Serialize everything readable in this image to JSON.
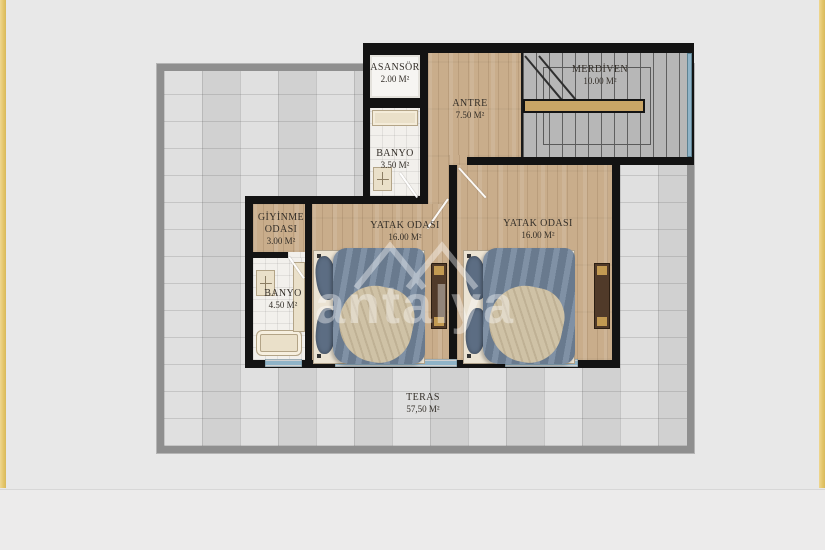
{
  "plan": {
    "watermark": "antalya",
    "rooms": {
      "asansor": {
        "name": "ASANSÖR",
        "area": "2.00 M²"
      },
      "banyo_ust": {
        "name": "BANYO",
        "area": "3.50 M²"
      },
      "antre": {
        "name": "ANTRE",
        "area": "7.50 M²"
      },
      "merdiven": {
        "name": "MERDİVEN",
        "area": "10.00 M²"
      },
      "giyinme": {
        "name": "GİYİNME ODASI",
        "area": "3.00 M²"
      },
      "banyo_alt": {
        "name": "BANYO",
        "area": "4.50 M²"
      },
      "yatak1": {
        "name": "YATAK ODASI",
        "area": "16.00 M²"
      },
      "yatak2": {
        "name": "YATAK ODASI",
        "area": "16.00 M²"
      },
      "teras": {
        "name": "TERAS",
        "area": "57,50 M²"
      }
    },
    "colors": {
      "wall": "#131313",
      "wood_floor": "#c9ad8b",
      "terrace_tile": "#d8d8d8",
      "railing": "#8f8f8f",
      "window_glass": "#8fb3c7",
      "page_trim_gold": "#e3c468",
      "duvet_blue": "#73869c",
      "handrail_wood": "#c9a566"
    }
  }
}
